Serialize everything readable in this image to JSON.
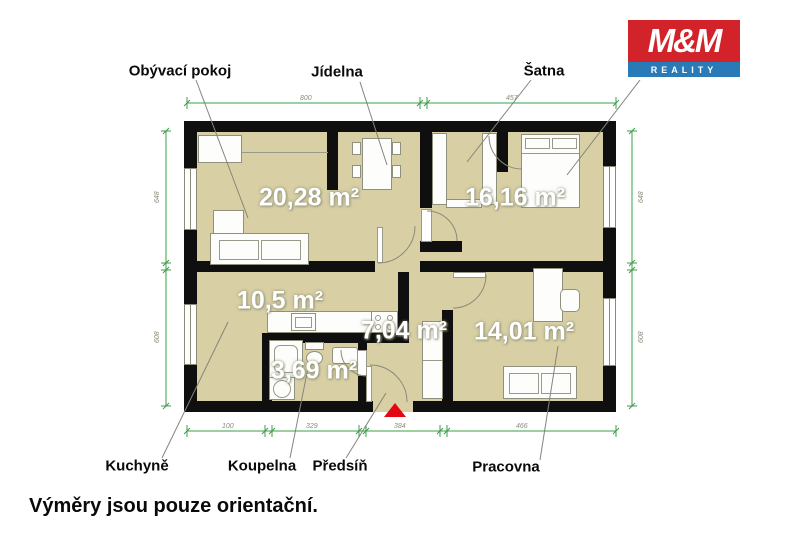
{
  "logo": {
    "top": "M&M",
    "bottom": "REALITY"
  },
  "room_labels": {
    "living": "Obývací pokoj",
    "dining": "Jídelna",
    "closet": "Šatna",
    "kitchen": "Kuchyně",
    "bathroom": "Koupelna",
    "hall": "Předsíň",
    "study": "Pracovna"
  },
  "areas": {
    "living": "20,28 m²",
    "bedroom": "16,16 m²",
    "kitchen": "10,5 m²",
    "hall": "7,04 m²",
    "bathroom": "3,69 m²",
    "study": "14,01 m²"
  },
  "dimensions": {
    "top": [
      "800",
      "457"
    ],
    "bottom": [
      "100",
      "329",
      "384",
      "466"
    ],
    "left": [
      "648",
      "608"
    ],
    "right": [
      "648",
      "608"
    ]
  },
  "disclaimer": "Výměry jsou pouze orientační.",
  "colors": {
    "wall": "#0f0f0f",
    "floor": "#d8d0a4",
    "dimension_line": "#3d9c47",
    "logo_red": "#d2232a",
    "logo_blue": "#2a7ab8",
    "entrance_marker": "#e30613"
  }
}
